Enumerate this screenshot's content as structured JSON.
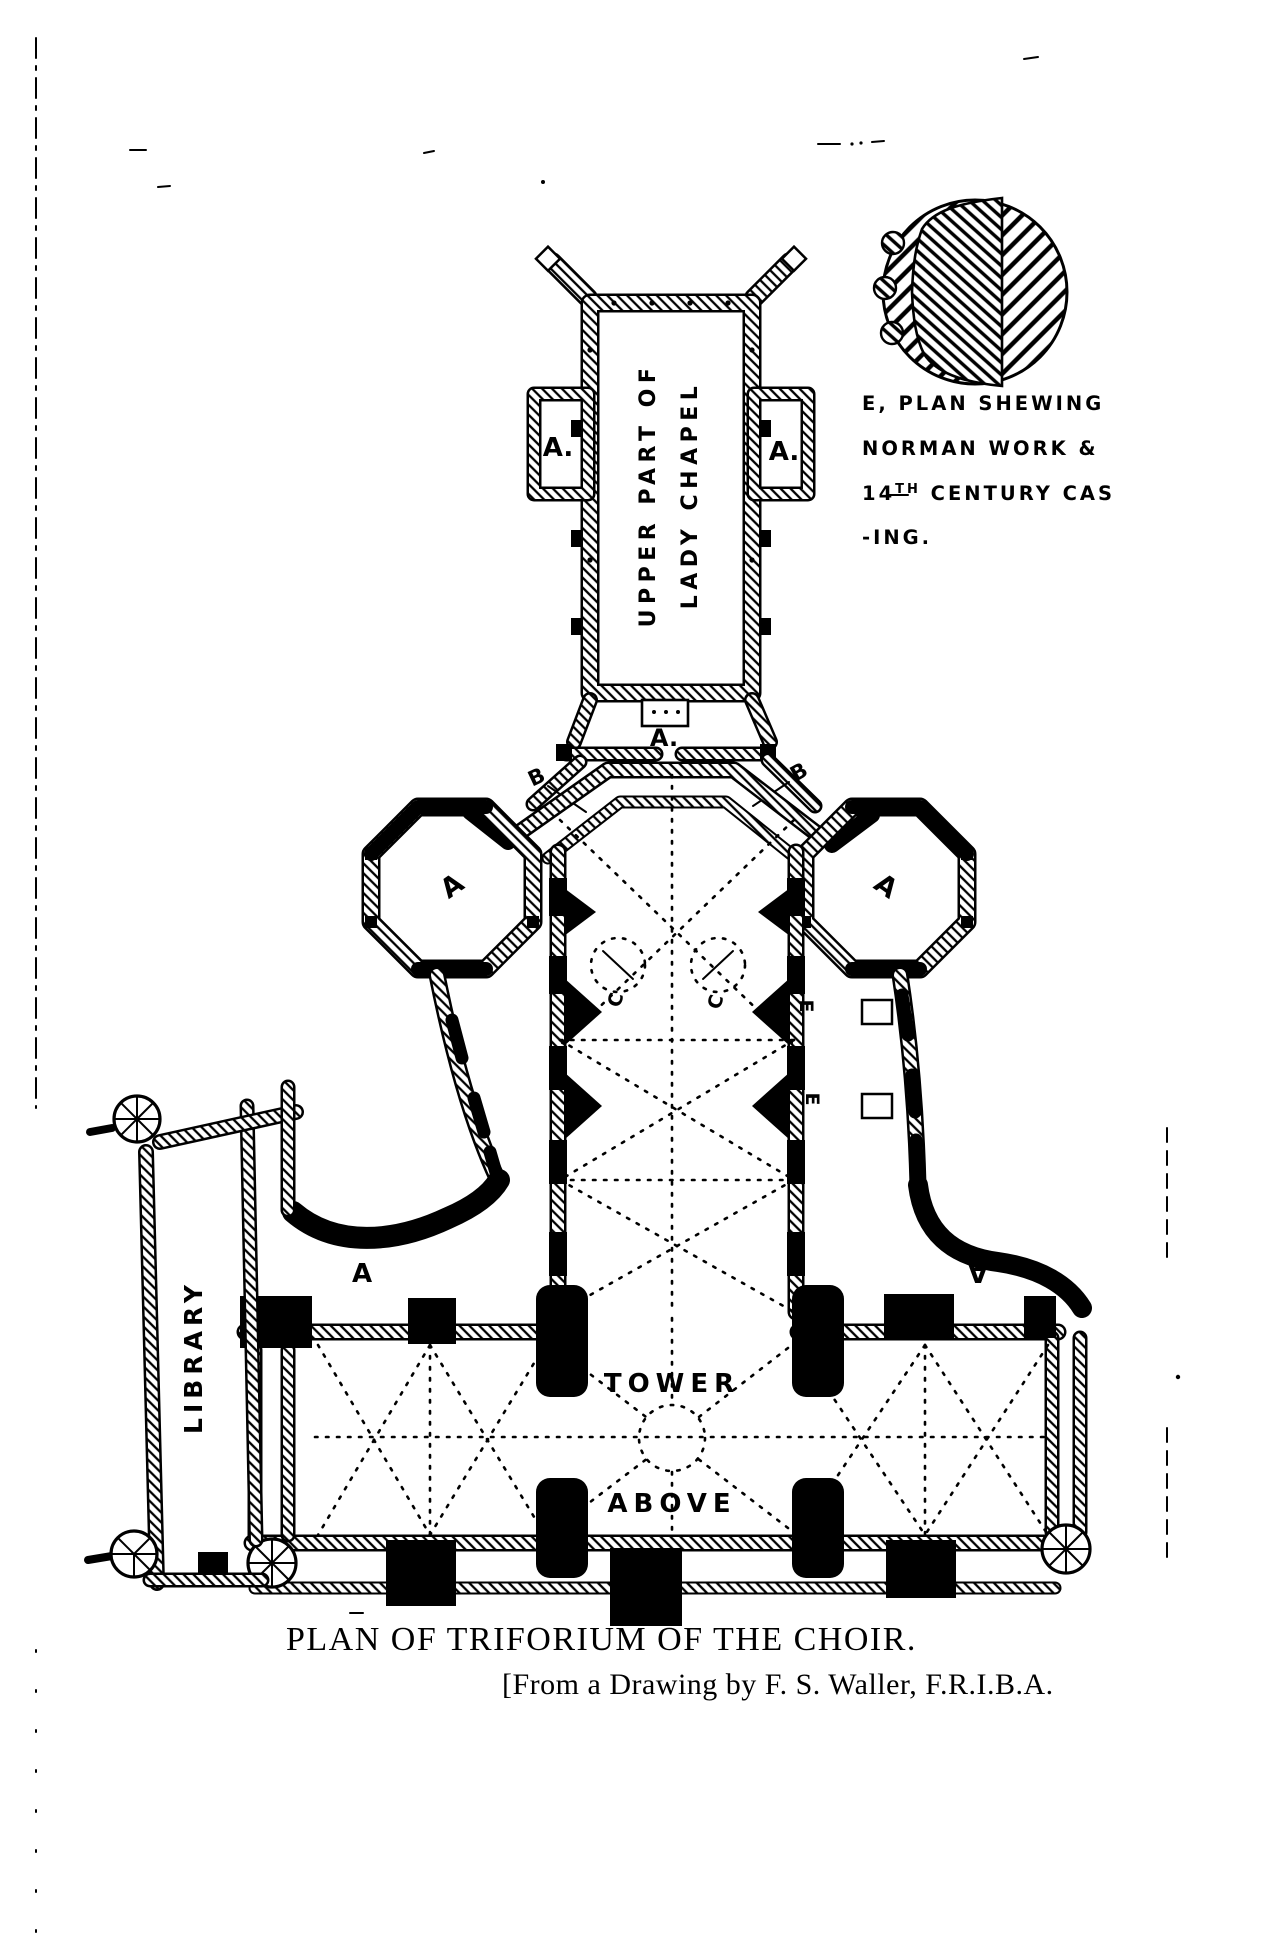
{
  "page": {
    "paper_color": "#ffffff",
    "ink_color": "#000000"
  },
  "legend": {
    "lines": {
      "line1": "E, PLAN SHEWING",
      "line2": "NORMAN WORK &",
      "line3_num": "14",
      "line3_sup": "TH",
      "line3_rest": " CENTURY CAS",
      "line4": "-ING."
    }
  },
  "plan": {
    "labels": {
      "lady_chapel_text1": "UPPER PART OF",
      "lady_chapel_text2": "LADY CHAPEL",
      "a_side_chapel_left": "A.",
      "a_side_chapel_right": "A.",
      "a_vestibule": "A.",
      "b_left": "B",
      "b_right": "B",
      "a_octagon_left": "A",
      "a_octagon_right": "A",
      "c_left": "C",
      "c_right": "C",
      "e_pier_upper": "E",
      "e_pier_lower": "E",
      "a_transept_left": "A",
      "a_transept_right": "A",
      "library": "LIBRARY",
      "tower": "TOWER",
      "above": "ABOVE"
    }
  },
  "caption": {
    "title": "PLAN OF TRIFORIUM OF THE CHOIR.",
    "credit": "[From a Drawing by F. S. Waller, F.R.I.B.A."
  }
}
